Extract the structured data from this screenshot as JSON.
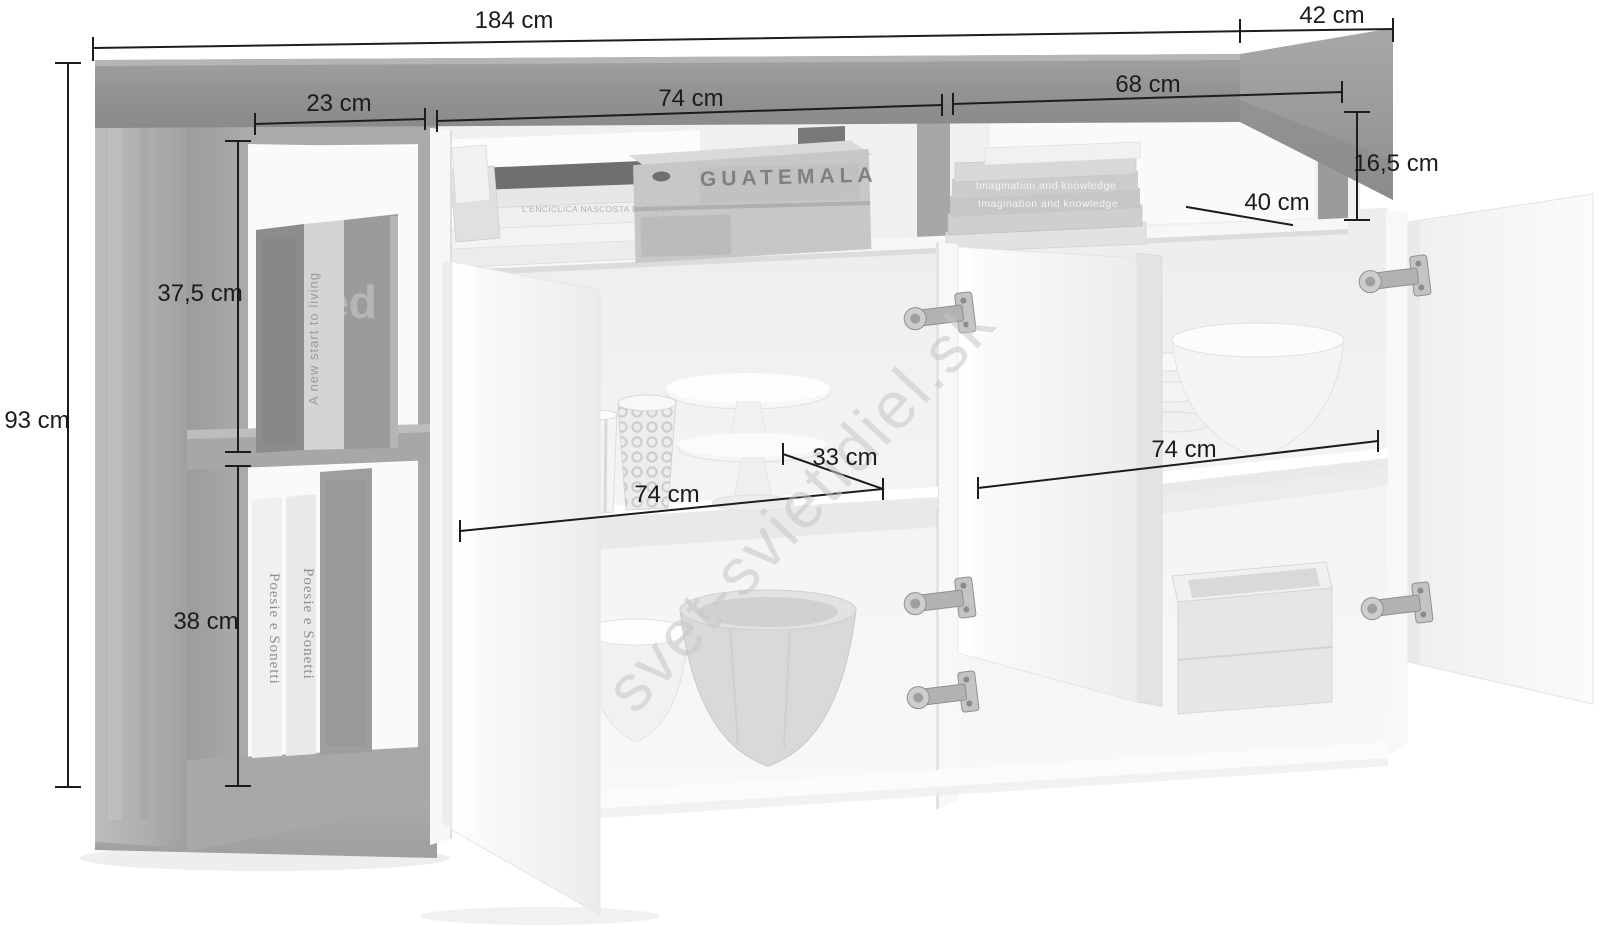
{
  "dimensions": {
    "total_width": "184 cm",
    "total_depth": "42 cm",
    "total_height": "93 cm",
    "left_compartment_width": "23 cm",
    "top_left_opening_width": "74 cm",
    "top_right_opening_width": "68 cm",
    "top_opening_height": "16,5 cm",
    "top_opening_depth": "40 cm",
    "left_upper_compartment_height": "37,5 cm",
    "left_lower_compartment_height": "38 cm",
    "middle_shelf_width": "74 cm",
    "middle_shelf_right_width": "33 cm",
    "right_shelf_width": "74 cm"
  },
  "props": {
    "crate_label": "GUATEMALA",
    "book_spine_living": "A new start to living",
    "book_spine_poesie_1": "Poesie e Sonetti",
    "book_spine_poesie_2": "Poesie e Sonetti",
    "book_title_imagination_1": "Imagination and knowledge",
    "book_title_imagination_2": "Imagination and knowledge",
    "book_spine_enciclica": "L'ENCICLICA NASCOSTA DI PIO XI"
  },
  "watermark": {
    "text": "svet-svietidiel.sk",
    "fragment": "ed"
  },
  "colors": {
    "annotation": "#1b1b1b",
    "watermark": "#c6c6c6",
    "furniture_gray": "#a7a7a7",
    "door_white": "#f7f7f7",
    "background": "#ffffff"
  }
}
